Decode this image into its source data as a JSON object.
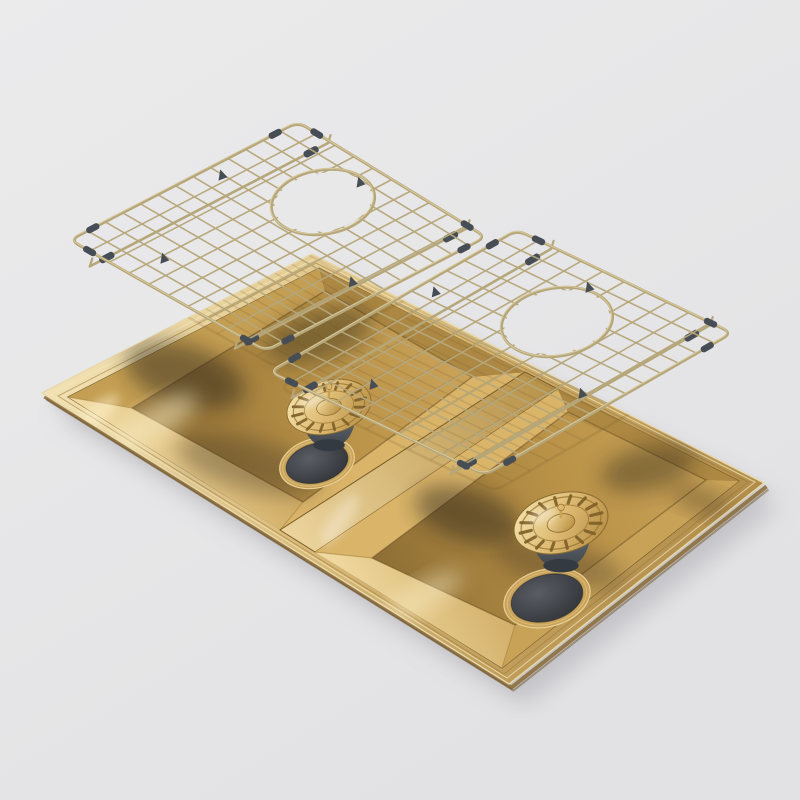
{
  "scene": {
    "type": "product-render",
    "description": "Exploded 3D render of a brushed brass gold double-bowl kitchen sink with two gold wire protection grids floating above the bowls and two gold basket strainer wastes hovering over the drain holes, on a plain light grey studio background",
    "objects": [
      {
        "name": "sink-body",
        "label": "Double bowl brass sink"
      },
      {
        "name": "left-grid",
        "label": "Left bowl protection grid with drain opening"
      },
      {
        "name": "right-grid",
        "label": "Right bowl protection grid with drain opening"
      },
      {
        "name": "left-strainer",
        "label": "Left basket strainer waste"
      },
      {
        "name": "right-strainer",
        "label": "Right basket strainer waste"
      },
      {
        "name": "left-drain",
        "label": "Left bowl drain hole"
      },
      {
        "name": "right-drain",
        "label": "Right bowl drain hole"
      }
    ]
  },
  "palette": {
    "bg-top": "#ebebec",
    "bg-bottom": "#e2e2e4",
    "gold-hi": "#f3e3b6",
    "gold-light": "#e9cf92",
    "gold-mid": "#c8a25c",
    "gold-deep": "#a37e3e",
    "gold-dark": "#7c5f2e",
    "wire": "#b6a77a",
    "wire-hi": "#ded0a4",
    "rubber": "#474d55",
    "rubber-dark": "#343a41",
    "drain-gray": "#484c52",
    "shadow": "#bdbdc2"
  }
}
